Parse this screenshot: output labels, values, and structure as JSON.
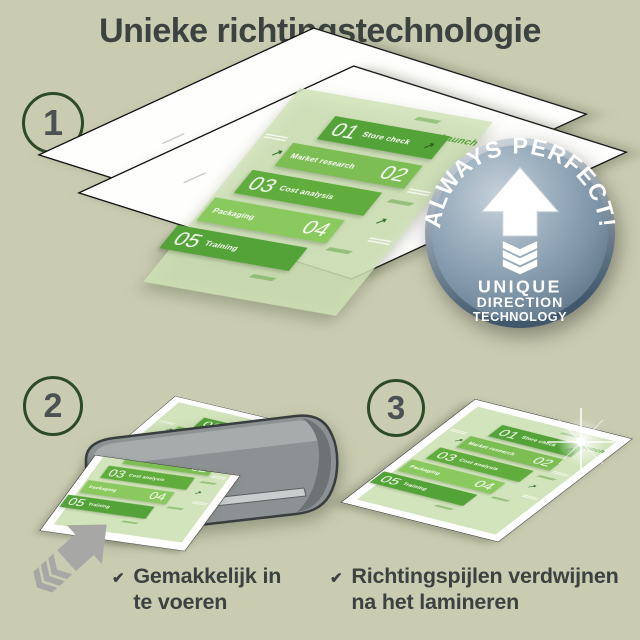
{
  "title": "Unieke richtingstechnologie",
  "steps": {
    "one": "1",
    "two": "2",
    "three": "3"
  },
  "badge": {
    "arc_text": "ALWAYS PERFECT!",
    "line1": "UNIQUE",
    "line2": "DIRECTION",
    "line3": "TECHNOLOGY"
  },
  "infographic": {
    "launch_label": "Launch",
    "steps": [
      {
        "num": "01",
        "label": "Store check"
      },
      {
        "num": "02",
        "label": "Market research"
      },
      {
        "num": "03",
        "label": "Cost analysis"
      },
      {
        "num": "04",
        "label": "Packaging"
      },
      {
        "num": "05",
        "label": "Training"
      }
    ]
  },
  "captions": {
    "easy_feed": {
      "line1": "Gemakkelijk in",
      "line2": "te voeren"
    },
    "arrows_gone": {
      "line1": "Richtingspijlen verdwijnen",
      "line2": "na het lamineren"
    }
  },
  "icons": {
    "check": "✔",
    "direction_arrow": "↗"
  },
  "colors": {
    "background": "#caccb2",
    "step_green_dark": "#54a338",
    "step_green_light": "#8ac95e",
    "doc_green": "#d2e4bb",
    "badge_blue_gray": "#7e95a8",
    "machine_gray": "#8c9193",
    "text_dark": "#3b4240",
    "circle_green": "#2c4a28"
  }
}
